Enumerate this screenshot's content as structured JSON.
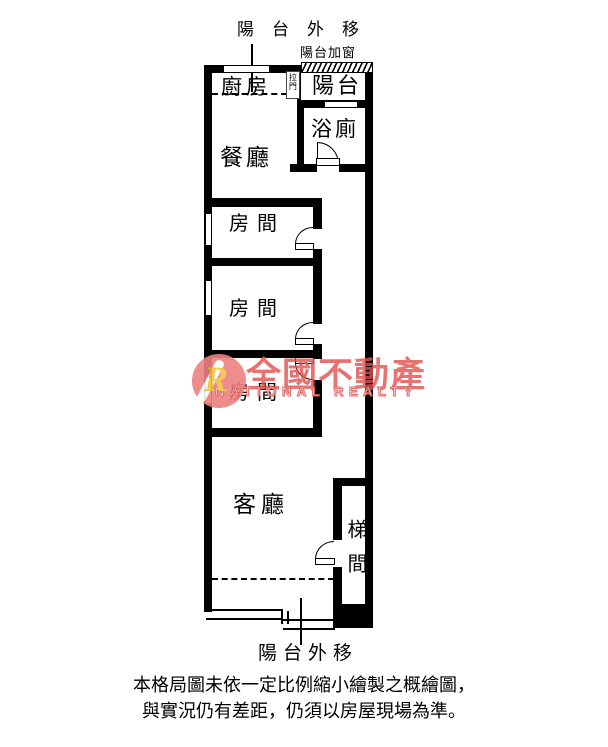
{
  "plan": {
    "annotations": {
      "top_balcony_out": "陽台外移",
      "balcony_added_window": "陽台加窗",
      "bottom_balcony_out": "陽台外移"
    },
    "rooms": {
      "kitchen": "廚房",
      "balcony": "陽台",
      "bathroom": "浴廁",
      "dining": "餐廳",
      "bedroom1": "房間",
      "bedroom2": "房間",
      "bedroom3": "房間",
      "living": "客廳",
      "stairwell": "梯間"
    },
    "fixtures": {
      "sliding_door": "拉門"
    }
  },
  "watermark": {
    "logo_letter": "R",
    "brand_zh": "全國不動產",
    "brand_en": "NATIONAL REALTY",
    "accent_color": "#e45c5c",
    "logo_color": "#ee8080",
    "logo_letter_color": "#f4c33c"
  },
  "disclaimer": {
    "line1": "本格局圖未依一定比例縮小繪製之概繪圖，",
    "line2": "與實況仍有差距，仍須以房屋現場為準。"
  }
}
